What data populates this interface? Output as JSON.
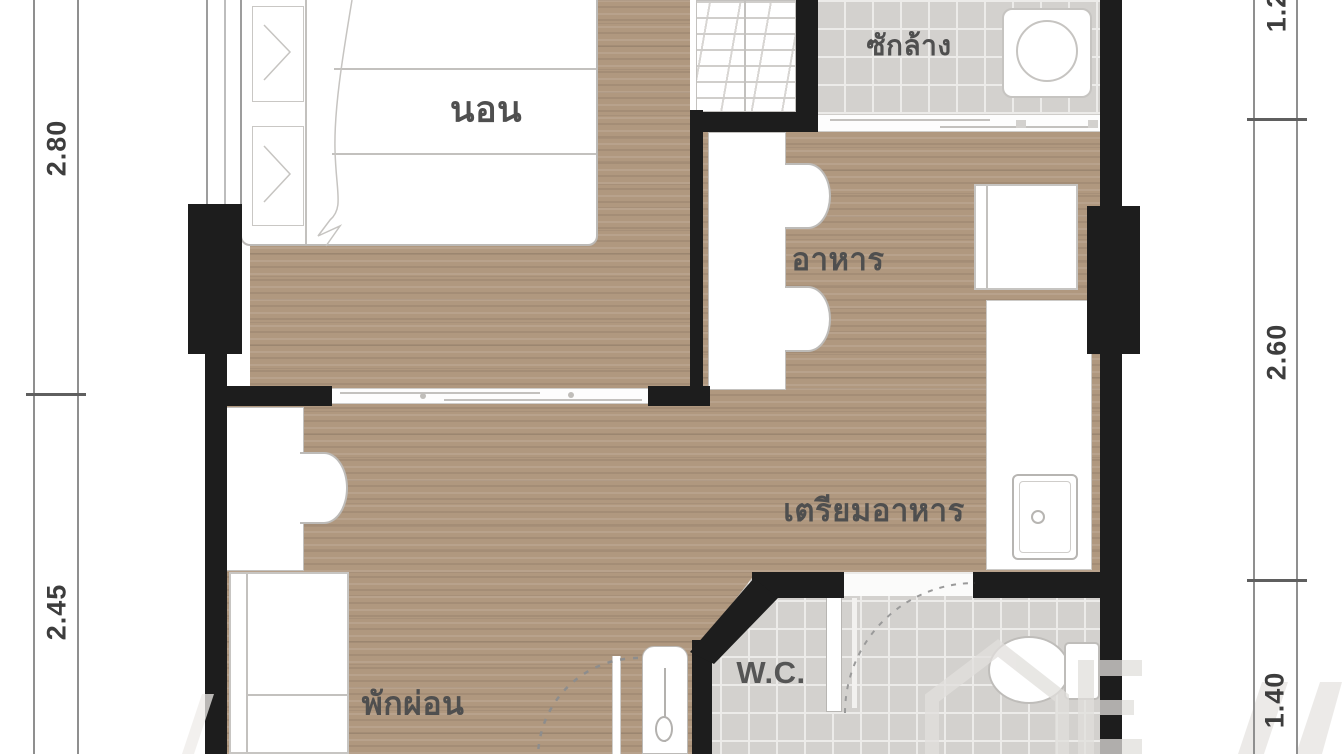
{
  "document": {
    "kind": "condo-unit-floor-plan"
  },
  "rooms": {
    "bedroom": {
      "label": "นอน"
    },
    "laundry": {
      "label": "ซักล้าง"
    },
    "dining": {
      "label": "อาหาร"
    },
    "kitchen": {
      "label": "เตรียมอาหาร"
    },
    "living": {
      "label": "พักผ่อน"
    },
    "wc": {
      "label": "W.C."
    }
  },
  "dimensions": {
    "left": [
      {
        "value": "2.80"
      },
      {
        "value": "2.45"
      }
    ],
    "right": [
      {
        "value": "1.20"
      },
      {
        "value": "2.60"
      },
      {
        "value": "1.40"
      }
    ]
  },
  "colors": {
    "wall": "#1d1d1d",
    "wood_floor": "#b0987f",
    "tile_floor": "#d3d1ce",
    "label_text": "#4f4f4f",
    "dimension_text": "#3d3d3d"
  },
  "furniture": [
    "bed",
    "wardrobe",
    "washing-machine",
    "dining-table",
    "dining-chair",
    "fridge",
    "kitchen-counter",
    "sink",
    "toilet",
    "desk",
    "desk-chair",
    "sofa",
    "entry-door",
    "wc-door"
  ]
}
